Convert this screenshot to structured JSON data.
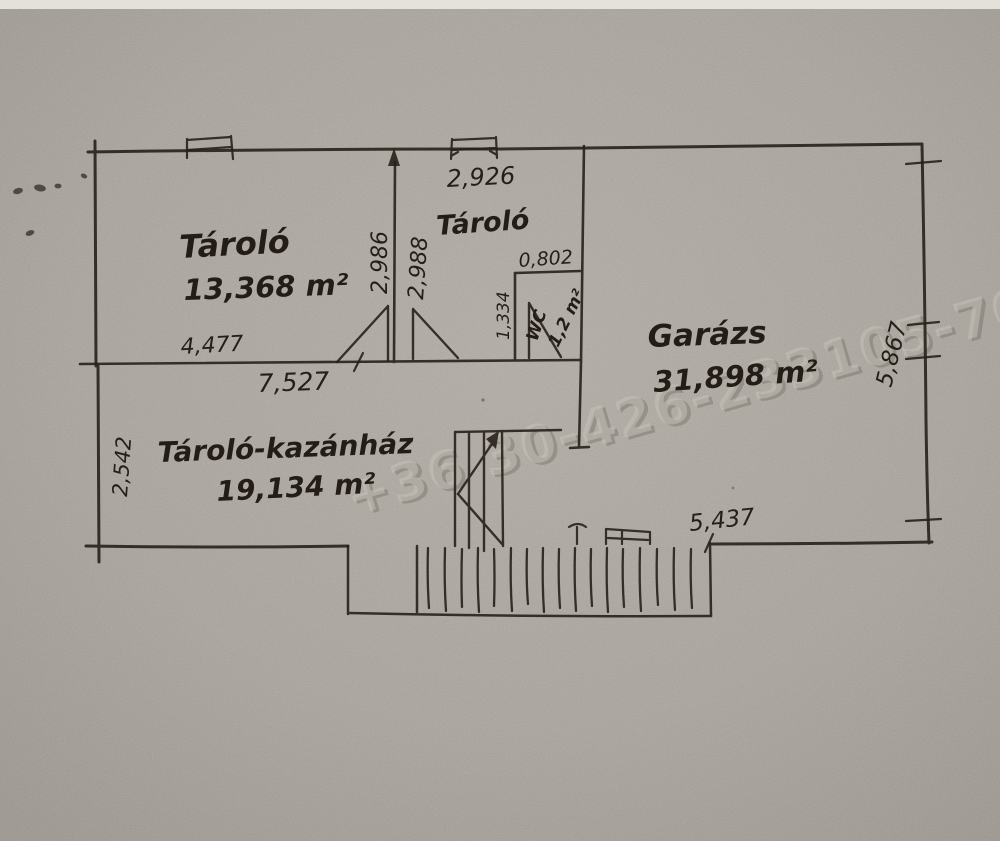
{
  "plan": {
    "rooms": [
      {
        "id": "storage-upper",
        "name": "Tároló",
        "area": "13,368 m²"
      },
      {
        "id": "storage-middle",
        "name": "Tároló",
        "area": ""
      },
      {
        "id": "wc",
        "name": "WC",
        "area": "1,2 m²"
      },
      {
        "id": "storage-boiler",
        "name": "Tároló-kazánház",
        "area": "19,134 m²"
      },
      {
        "id": "garage",
        "name": "Garázs",
        "area": "31,898 m²"
      }
    ],
    "dimensions": {
      "middle_room_width": "2,926",
      "wc_door_width": "0,802",
      "wc_depth": "1,334",
      "storage_depth_left": "2,986",
      "storage_depth_right": "2,988",
      "storage_width": "4,477",
      "lower_rooms_width": "7,527",
      "boiler_room_depth": "2,542",
      "garage_depth": "5,867",
      "garage_width": "5,437"
    },
    "watermark": "+36 30-426-233105-70-209-2",
    "ink_color": "#28211b",
    "paper_color": "#aba69e"
  }
}
